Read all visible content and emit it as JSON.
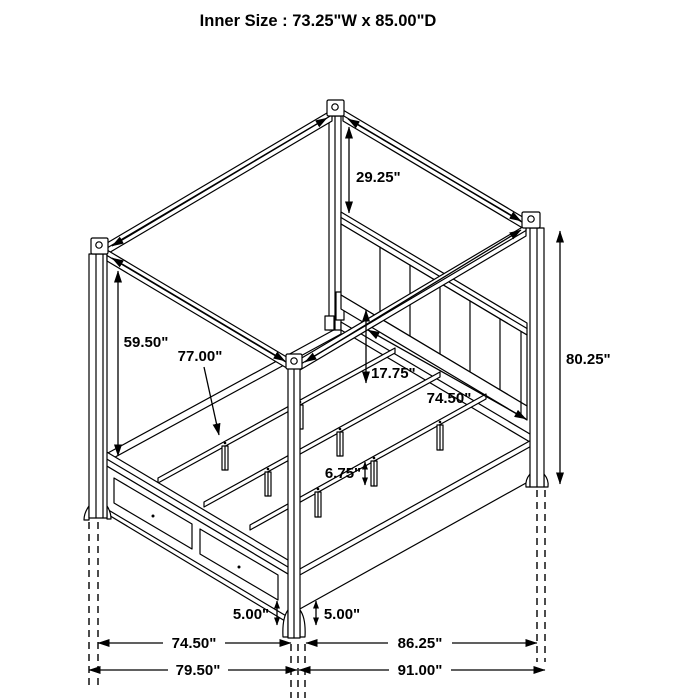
{
  "title": "Inner Size : 73.25\"W x 85.00\"D",
  "colors": {
    "line": "#000000",
    "background": "#ffffff",
    "text": "#000000"
  },
  "labels": {
    "dim_29_25": "29.25\"",
    "dim_59_50": "59.50\"",
    "dim_77_00": "77.00\"",
    "dim_17_75": "17.75\"",
    "dim_74_50_deck": "74.50\"",
    "dim_80_25": "80.25\"",
    "dim_6_75": "6.75\"",
    "dim_5_00_left": "5.00\"",
    "dim_5_00_right": "5.00\"",
    "dim_74_50_bottom": "74.50\"",
    "dim_79_50": "79.50\"",
    "dim_86_25": "86.25\"",
    "dim_91_00": "91.00\""
  }
}
